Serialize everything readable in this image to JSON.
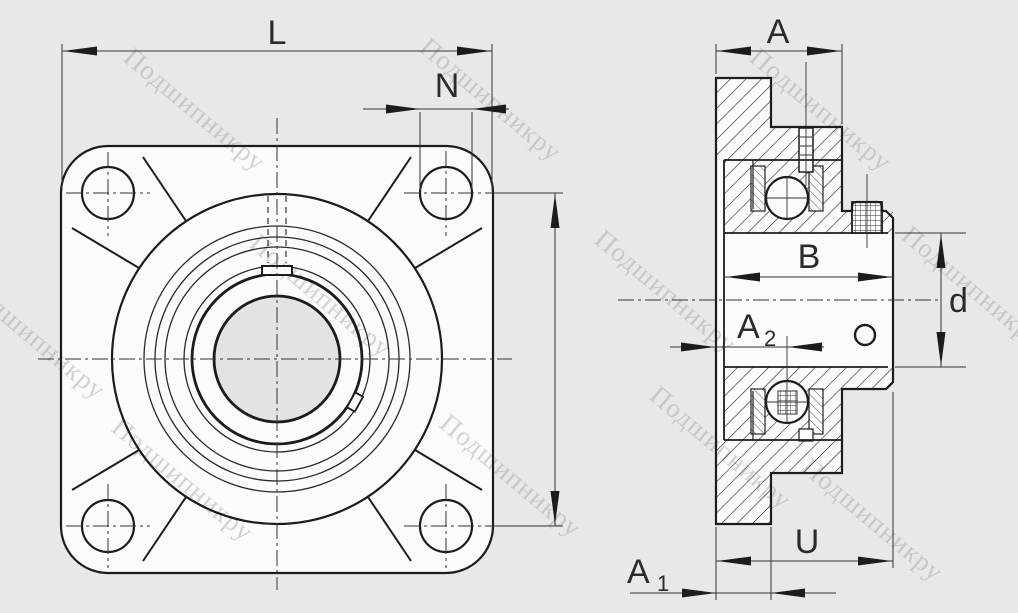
{
  "watermark": {
    "text": "Подшипникру"
  },
  "dimensions": {
    "L": "L",
    "N": "N",
    "A": "A",
    "B": "B",
    "d": "d",
    "U": "U",
    "A1": {
      "base": "A",
      "sub": "1"
    },
    "A2": {
      "base": "A",
      "sub": "2"
    }
  }
}
